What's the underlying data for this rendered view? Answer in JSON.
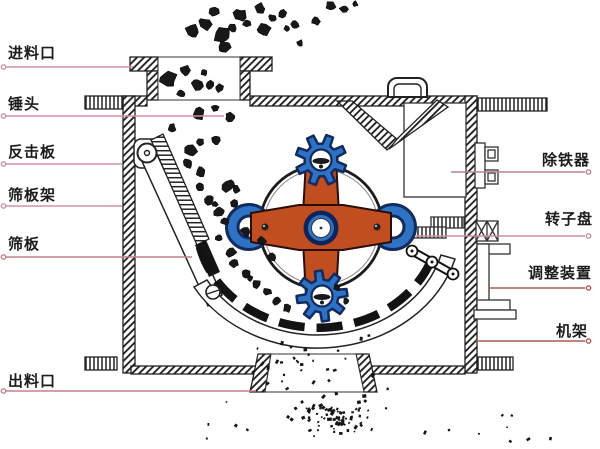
{
  "figure": {
    "type": "technical-diagram",
    "subject": "impact crusher internal structure diagram",
    "canvas": {
      "width": 600,
      "height": 449,
      "background": "#ffffff"
    },
    "colors": {
      "ink": "#1c1c1c",
      "rotor_orange": "#c04e20",
      "hammer_blue": "#2e72c4",
      "outline_navy": "#122a5e",
      "rock_black": "#181818",
      "label_text": "#1c1c1c"
    },
    "labels": {
      "left": [
        {
          "text": "进料口",
          "x": 8,
          "y": 45,
          "line": {
            "x1": 6,
            "x2": 133,
            "y": 67
          },
          "line_color": "#cf93a4"
        },
        {
          "text": "锤头",
          "x": 8,
          "y": 96,
          "line": {
            "x1": 6,
            "x2": 224,
            "y": 116
          },
          "line_color": "#cf93a4"
        },
        {
          "text": "反击板",
          "x": 8,
          "y": 144,
          "line": {
            "x1": 6,
            "x2": 122,
            "y": 164
          },
          "line_color": "#cf93a4"
        },
        {
          "text": "筛板架",
          "x": 8,
          "y": 187,
          "line": {
            "x1": 6,
            "x2": 122,
            "y": 206
          },
          "line_color": "#cf93a4"
        },
        {
          "text": "筛板",
          "x": 8,
          "y": 236,
          "line": {
            "x1": 6,
            "x2": 192,
            "y": 257
          },
          "line_color": "#c3808d"
        },
        {
          "text": "出料口",
          "x": 8,
          "y": 373,
          "line": {
            "x1": 6,
            "x2": 256,
            "y": 391
          },
          "line_color": "#c3808d"
        }
      ],
      "right": [
        {
          "text": "除铁器",
          "x": 542,
          "y": 152,
          "line": {
            "x1": 451,
            "x2": 585,
            "y": 172
          },
          "line_color": "#b9848e"
        },
        {
          "text": "转子盘",
          "x": 545,
          "y": 211,
          "line": {
            "x1": 416,
            "x2": 585,
            "y": 236
          },
          "line_color": "#c9909c"
        },
        {
          "text": "调整装置",
          "x": 528,
          "y": 265,
          "line": {
            "x1": 489,
            "x2": 585,
            "y": 288
          },
          "line_color": "#ad5f56"
        },
        {
          "text": "机架",
          "x": 556,
          "y": 323,
          "line": {
            "x1": 476,
            "x2": 585,
            "y": 341
          },
          "line_color": "#a85c52"
        }
      ]
    },
    "rocks": [
      [
        193,
        32,
        7
      ],
      [
        205,
        24,
        6
      ],
      [
        214,
        11,
        5
      ],
      [
        222,
        35,
        8
      ],
      [
        224,
        47,
        6
      ],
      [
        240,
        15,
        6
      ],
      [
        247,
        23,
        4
      ],
      [
        233,
        28,
        4
      ],
      [
        260,
        8,
        5
      ],
      [
        264,
        30,
        6
      ],
      [
        272,
        18,
        4
      ],
      [
        283,
        14,
        4
      ],
      [
        295,
        25,
        4
      ],
      [
        287,
        28,
        3
      ],
      [
        300,
        43,
        3
      ],
      [
        316,
        21,
        4
      ],
      [
        331,
        6,
        5
      ],
      [
        344,
        9,
        4
      ],
      [
        355,
        4,
        3
      ],
      [
        168,
        79,
        8
      ],
      [
        186,
        70,
        5
      ],
      [
        197,
        84,
        6
      ],
      [
        210,
        85,
        4
      ],
      [
        219,
        88,
        4
      ],
      [
        181,
        93,
        4
      ],
      [
        204,
        73,
        3
      ],
      [
        198,
        114,
        6
      ],
      [
        230,
        118,
        5
      ],
      [
        215,
        108,
        4
      ],
      [
        172,
        128,
        4
      ],
      [
        191,
        150,
        6
      ],
      [
        200,
        142,
        4
      ],
      [
        188,
        163,
        5
      ],
      [
        201,
        171,
        5
      ],
      [
        216,
        140,
        4
      ],
      [
        228,
        186,
        6
      ],
      [
        236,
        189,
        4
      ],
      [
        209,
        200,
        5
      ],
      [
        215,
        204,
        3
      ],
      [
        200,
        187,
        4
      ],
      [
        219,
        212,
        5
      ],
      [
        225,
        221,
        4
      ],
      [
        234,
        204,
        4
      ],
      [
        246,
        231,
        5
      ],
      [
        219,
        238,
        4
      ],
      [
        231,
        252,
        5
      ],
      [
        234,
        263,
        4
      ],
      [
        246,
        274,
        4
      ],
      [
        250,
        279,
        3
      ],
      [
        257,
        284,
        4
      ],
      [
        267,
        292,
        4
      ],
      [
        277,
        301,
        4
      ],
      [
        287,
        308,
        4
      ],
      [
        262,
        241,
        4
      ],
      [
        272,
        257,
        4
      ],
      [
        337,
        288,
        3
      ],
      [
        346,
        301,
        3
      ]
    ],
    "particle_clusters": [
      {
        "mode": "uniform",
        "x": 252,
        "y": 333,
        "w": 136,
        "h": 56,
        "n": 30,
        "smin": 1.5,
        "smax": 3.0
      },
      {
        "mode": "gauss",
        "cx": 332,
        "cy": 413,
        "rx": 58,
        "ry": 29,
        "n": 75,
        "smin": 1.5,
        "smax": 3.5
      },
      {
        "mode": "uniform",
        "x": 196,
        "y": 393,
        "w": 360,
        "h": 52,
        "n": 20,
        "smin": 1.5,
        "smax": 3.0
      }
    ]
  }
}
